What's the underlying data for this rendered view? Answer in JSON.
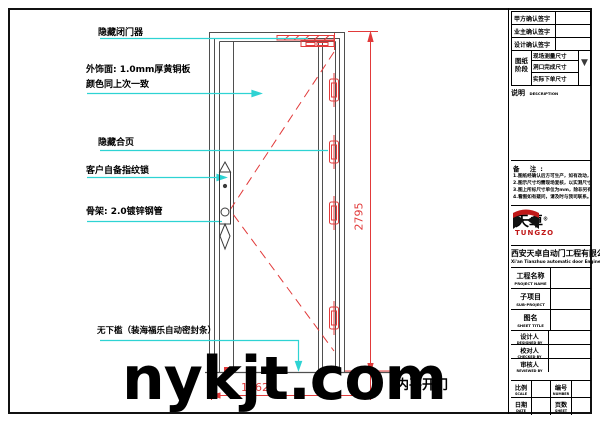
{
  "colors": {
    "dimension_red": "#e13a3a",
    "leader_cyan": "#2ed3d3",
    "drawing_line": "#4f4f4f",
    "logo_red": "#c01818"
  },
  "watermark": "nykjt.com",
  "drawing": {
    "door_type_label": "内平开门",
    "dim_width": "1062",
    "dim_height": "2795",
    "annotations": [
      {
        "text": "隐藏闭门器"
      },
      {
        "text": "外饰面: 1.0mm厚黄铜板"
      },
      {
        "text": "颜色同上次一致"
      },
      {
        "text": "隐藏合页"
      },
      {
        "text": "客户自备指纹锁"
      },
      {
        "text": "骨架: 2.0镀锌钢管"
      },
      {
        "text": "无下槛（装海福乐自动密封条）"
      }
    ]
  },
  "icons": {
    "stage_marker": "▼"
  },
  "title_block": {
    "signatures": [
      "甲方确认签字",
      "业主确认签字",
      "设计确认签字"
    ],
    "stage": {
      "label_top": "图纸",
      "label_bottom": "阶段",
      "rows": [
        "现场测量尺寸",
        "洞口完成尺寸",
        "实际下单尺寸"
      ]
    },
    "description": {
      "cn": "说明",
      "en": "DESCRIPTION"
    },
    "notes": {
      "title": "备  注:",
      "lines": [
        "1.图纸经确认后方可生产，如有改动，不得生效。",
        "2.图示尺寸均需现场复核，以实测尺寸为准。",
        "3.图上所标尺寸单位为mm，除非另有标注。",
        "4.看图如有疑问，请及时与我司联系。"
      ]
    },
    "logo": {
      "cn": "天卓",
      "reg": "®",
      "en": "TUNGZO"
    },
    "company": {
      "cn": "西安天卓自动门工程有限公司",
      "en": "Xi'an Tianzhuo automatic door Engineering Co. Ltd."
    },
    "project_rows": [
      {
        "cn": "工程名称",
        "en": "PROJECT NAME"
      },
      {
        "cn": "子项目",
        "en": "SUB-PROJECT"
      },
      {
        "cn": "图名",
        "en": "SHEET TITLE"
      }
    ],
    "people_rows": [
      {
        "cn": "设计人",
        "en": "DESIGNED BY"
      },
      {
        "cn": "校对人",
        "en": "CHECKED BY"
      },
      {
        "cn": "审核人",
        "en": "REVIEWED BY"
      }
    ],
    "footer": {
      "scale": {
        "cn": "比例",
        "en": "SCALE"
      },
      "number": {
        "cn": "编号",
        "en": "NUMBER"
      },
      "date": {
        "cn": "日期",
        "en": "DATE"
      },
      "sheet": {
        "cn": "页数",
        "en": "SHEET"
      }
    }
  }
}
